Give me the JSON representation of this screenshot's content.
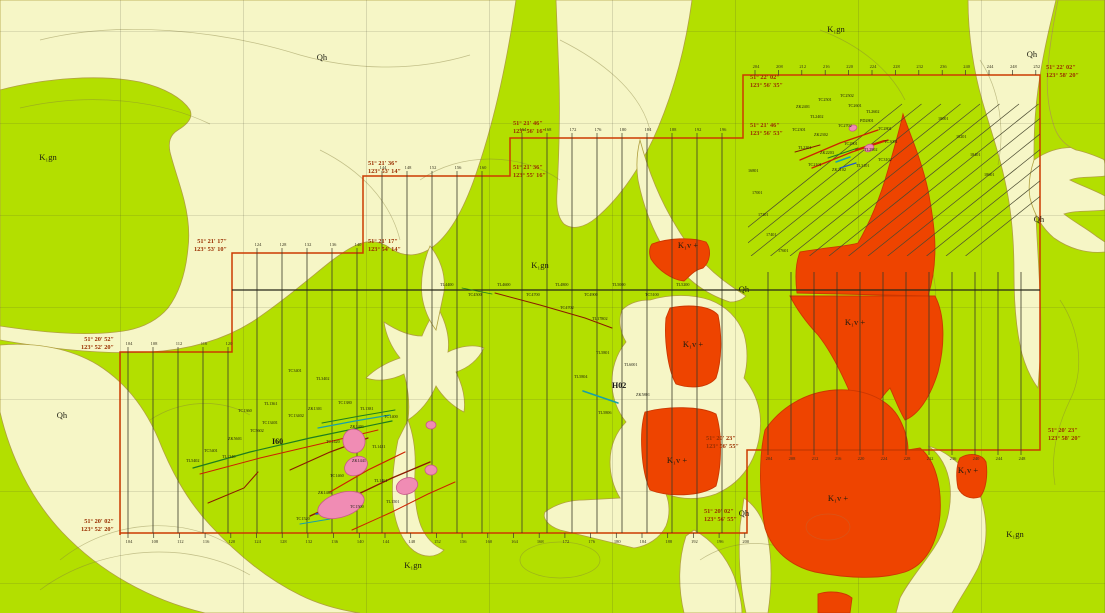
{
  "map_title": "Geological survey map",
  "colors": {
    "green": "#b3df00",
    "cream": "#f6f6c6",
    "red": "#ee4400",
    "red_stroke": "#cc3700",
    "pink": "#f08cb4",
    "pink_stroke": "#c85888",
    "unit_boundary": "#b0a040",
    "boundary": "#cc3a00",
    "coord_text": "#9a2f00",
    "survey_line": "#3a3a28",
    "baseline": "#26261a",
    "contour": "rgba(130,125,60,0.45)",
    "red_contour": "rgba(205,95,40,0.65)",
    "graticule": "rgba(70,70,50,0.28)",
    "hatch": "#4a4a30",
    "tick_text": "#33301c",
    "tiny_text": "#1a1a10",
    "vein_red": "#cc2200",
    "vein_darkred": "#8b1a00",
    "vein_green": "#1e7d1e",
    "vein_teal": "#18a0a8",
    "vein_blue": "#2255cc"
  },
  "unit_labels": [
    {
      "t": "Qh",
      "x": 322,
      "y": 60
    },
    {
      "t": "K₁gn",
      "x": 48,
      "y": 160
    },
    {
      "t": "K₁gn",
      "x": 836,
      "y": 32
    },
    {
      "t": "Qh",
      "x": 1032,
      "y": 57
    },
    {
      "t": "Qh",
      "x": 1039,
      "y": 222
    },
    {
      "t": "Qh",
      "x": 62,
      "y": 418
    },
    {
      "t": "K₁gn",
      "x": 540,
      "y": 268
    },
    {
      "t": "Qh",
      "x": 744,
      "y": 292
    },
    {
      "t": "K₁v +",
      "x": 688,
      "y": 248
    },
    {
      "t": "K₁v +",
      "x": 855,
      "y": 325
    },
    {
      "t": "K₁v +",
      "x": 693,
      "y": 347
    },
    {
      "t": "K₁v +",
      "x": 677,
      "y": 463
    },
    {
      "t": "K₁v +",
      "x": 838,
      "y": 501
    },
    {
      "t": "K₁v +",
      "x": 968,
      "y": 473
    },
    {
      "t": "K₁gn",
      "x": 1015,
      "y": 537
    },
    {
      "t": "K₁gn",
      "x": 413,
      "y": 568
    },
    {
      "t": "Qh",
      "x": 744,
      "y": 516
    }
  ],
  "coord_labels": [
    {
      "l1": "51° 20′ 52″",
      "l2": "123° 52′ 20″",
      "x": 114,
      "y": 341,
      "anchor": "end"
    },
    {
      "l1": "51° 20′ 02″",
      "l2": "123° 52′ 20″",
      "x": 114,
      "y": 523,
      "anchor": "end"
    },
    {
      "l1": "51° 21′ 17″",
      "l2": "123° 53′ 10″",
      "x": 227,
      "y": 243,
      "anchor": "end"
    },
    {
      "l1": "51° 21′ 17″",
      "l2": "123° 54′ 14″",
      "x": 368,
      "y": 243,
      "anchor": "start"
    },
    {
      "l1": "51° 21′ 36″",
      "l2": "123° 53′ 14″",
      "x": 368,
      "y": 165,
      "anchor": "start"
    },
    {
      "l1": "51° 21′ 46″",
      "l2": "123° 56′ 16″",
      "x": 513,
      "y": 125,
      "anchor": "start"
    },
    {
      "l1": "51° 21′ 36″",
      "l2": "123° 55′ 16″",
      "x": 513,
      "y": 169,
      "anchor": "start"
    },
    {
      "l1": "51° 22′ 02″",
      "l2": "123° 56′ 35″",
      "x": 750,
      "y": 79,
      "anchor": "start"
    },
    {
      "l1": "51° 21′ 46″",
      "l2": "123° 56′ 53″",
      "x": 750,
      "y": 127,
      "anchor": "start"
    },
    {
      "l1": "51° 22′ 02″",
      "l2": "123° 58′ 20″",
      "x": 1046,
      "y": 69,
      "anchor": "start"
    },
    {
      "l1": "51° 20′ 23″",
      "l2": "123° 58′ 20″",
      "x": 1048,
      "y": 432,
      "anchor": "start"
    },
    {
      "l1": "51° 20′ 23″",
      "l2": "123° 56′ 55″",
      "x": 706,
      "y": 440,
      "anchor": "start"
    },
    {
      "l1": "51° 20′ 02″",
      "l2": "123° 56′ 55″",
      "x": 704,
      "y": 513,
      "anchor": "start"
    }
  ],
  "feature_labels": [
    {
      "t": "I60",
      "x": 272,
      "y": 444
    },
    {
      "t": "H02",
      "x": 612,
      "y": 388
    }
  ],
  "tick_rows": [
    {
      "edge_y": 352,
      "dir": -1,
      "x0": 128,
      "step": 25,
      "labels": [
        "104",
        "108",
        "112",
        "116",
        "120"
      ]
    },
    {
      "edge_y": 253,
      "dir": -1,
      "x0": 257,
      "step": 25,
      "labels": [
        "124",
        "128",
        "132",
        "136",
        "140"
      ]
    },
    {
      "edge_y": 176,
      "dir": -1,
      "x0": 382,
      "step": 25,
      "labels": [
        "144",
        "148",
        "152",
        "156",
        "160"
      ]
    },
    {
      "edge_y": 138,
      "dir": -1,
      "x0": 522,
      "step": 25,
      "labels": [
        "164",
        "168",
        "172",
        "176",
        "180",
        "184",
        "188",
        "192",
        "196"
      ]
    },
    {
      "edge_y": 75,
      "dir": -1,
      "x0": 755,
      "step": 23.4,
      "labels": [
        "204",
        "208",
        "212",
        "216",
        "220",
        "224",
        "228",
        "232",
        "236",
        "240",
        "244",
        "248",
        "252"
      ]
    },
    {
      "edge_y": 450,
      "dir": 1,
      "x0": 768,
      "step": 23,
      "labels": [
        "204",
        "208",
        "212",
        "216",
        "220",
        "224",
        "228",
        "232",
        "236",
        "240",
        "244",
        "248"
      ]
    },
    {
      "edge_y": 533,
      "dir": 1,
      "x0": 128,
      "step": 25.7,
      "labels": [
        "104",
        "108",
        "112",
        "116",
        "120",
        "124",
        "128",
        "132",
        "136",
        "140",
        "144",
        "148",
        "152",
        "156",
        "160",
        "164",
        "168",
        "172",
        "176",
        "180",
        "184",
        "188",
        "192",
        "196",
        "200"
      ]
    }
  ],
  "tiny_labels": [
    {
      "t": "TC5401",
      "x": 204,
      "y": 452
    },
    {
      "t": "TL5402",
      "x": 186,
      "y": 462
    },
    {
      "t": "ZK5601",
      "x": 228,
      "y": 440
    },
    {
      "t": "TC5602",
      "x": 250,
      "y": 432
    },
    {
      "t": "TL1340",
      "x": 222,
      "y": 458
    },
    {
      "t": "TC13401",
      "x": 262,
      "y": 424
    },
    {
      "t": "TC13402",
      "x": 288,
      "y": 417
    },
    {
      "t": "ZK1301",
      "x": 308,
      "y": 410
    },
    {
      "t": "TC1360",
      "x": 238,
      "y": 412
    },
    {
      "t": "TL1361",
      "x": 264,
      "y": 405
    },
    {
      "t": "TC1380",
      "x": 338,
      "y": 404
    },
    {
      "t": "TL1381",
      "x": 360,
      "y": 410
    },
    {
      "t": "TC1400",
      "x": 384,
      "y": 418
    },
    {
      "t": "ZK1401",
      "x": 350,
      "y": 428
    },
    {
      "t": "TC1420",
      "x": 326,
      "y": 443
    },
    {
      "t": "TL1421",
      "x": 372,
      "y": 448
    },
    {
      "t": "ZK1441",
      "x": 352,
      "y": 462
    },
    {
      "t": "TC1460",
      "x": 330,
      "y": 477
    },
    {
      "t": "TL1461",
      "x": 374,
      "y": 482
    },
    {
      "t": "ZK1481",
      "x": 318,
      "y": 494
    },
    {
      "t": "TC1500",
      "x": 350,
      "y": 508
    },
    {
      "t": "TL1501",
      "x": 386,
      "y": 503
    },
    {
      "t": "TC1520",
      "x": 296,
      "y": 520
    },
    {
      "t": "TC3401",
      "x": 288,
      "y": 372
    },
    {
      "t": "TL3402",
      "x": 316,
      "y": 380
    },
    {
      "t": "ZK2401",
      "x": 796,
      "y": 108
    },
    {
      "t": "TC2501",
      "x": 818,
      "y": 101
    },
    {
      "t": "TC2502",
      "x": 840,
      "y": 97
    },
    {
      "t": "TL2402",
      "x": 810,
      "y": 118
    },
    {
      "t": "TC2601",
      "x": 848,
      "y": 107
    },
    {
      "t": "TL2602",
      "x": 866,
      "y": 113
    },
    {
      "t": "TC2301",
      "x": 792,
      "y": 131
    },
    {
      "t": "ZK2302",
      "x": 814,
      "y": 136
    },
    {
      "t": "TC2702",
      "x": 838,
      "y": 127
    },
    {
      "t": "PD2801",
      "x": 860,
      "y": 122
    },
    {
      "t": "TC2801",
      "x": 878,
      "y": 130
    },
    {
      "t": "TL2201",
      "x": 798,
      "y": 149
    },
    {
      "t": "ZK2203",
      "x": 820,
      "y": 154
    },
    {
      "t": "TC2901",
      "x": 844,
      "y": 145
    },
    {
      "t": "TL2902",
      "x": 864,
      "y": 151
    },
    {
      "t": "TC3001",
      "x": 884,
      "y": 143
    },
    {
      "t": "TC2101",
      "x": 808,
      "y": 166
    },
    {
      "t": "ZK2102",
      "x": 832,
      "y": 171
    },
    {
      "t": "TL3101",
      "x": 856,
      "y": 167
    },
    {
      "t": "TC3102",
      "x": 878,
      "y": 161
    },
    {
      "t": "16801",
      "x": 748,
      "y": 172
    },
    {
      "t": "17001",
      "x": 752,
      "y": 194
    },
    {
      "t": "17201",
      "x": 758,
      "y": 216
    },
    {
      "t": "17401",
      "x": 766,
      "y": 236
    },
    {
      "t": "17601",
      "x": 778,
      "y": 252
    },
    {
      "t": "18001",
      "x": 938,
      "y": 120
    },
    {
      "t": "18201",
      "x": 956,
      "y": 138
    },
    {
      "t": "18401",
      "x": 970,
      "y": 156
    },
    {
      "t": "18601",
      "x": 984,
      "y": 176
    },
    {
      "t": "TL4400",
      "x": 440,
      "y": 286
    },
    {
      "t": "TC4500",
      "x": 468,
      "y": 296
    },
    {
      "t": "TL4600",
      "x": 497,
      "y": 286
    },
    {
      "t": "TC4700",
      "x": 526,
      "y": 296
    },
    {
      "t": "TL4800",
      "x": 555,
      "y": 286
    },
    {
      "t": "TC4900",
      "x": 584,
      "y": 296
    },
    {
      "t": "TL5000",
      "x": 612,
      "y": 286
    },
    {
      "t": "TC5100",
      "x": 645,
      "y": 296
    },
    {
      "t": "TL5200",
      "x": 676,
      "y": 286
    },
    {
      "t": "TL17802",
      "x": 592,
      "y": 320
    },
    {
      "t": "TC4702",
      "x": 560,
      "y": 309
    },
    {
      "t": "TL5801",
      "x": 596,
      "y": 354
    },
    {
      "t": "TL6001",
      "x": 624,
      "y": 366
    },
    {
      "t": "TL5806",
      "x": 598,
      "y": 414
    },
    {
      "t": "TL5804",
      "x": 574,
      "y": 378
    },
    {
      "t": "ZK5801",
      "x": 636,
      "y": 396
    }
  ]
}
